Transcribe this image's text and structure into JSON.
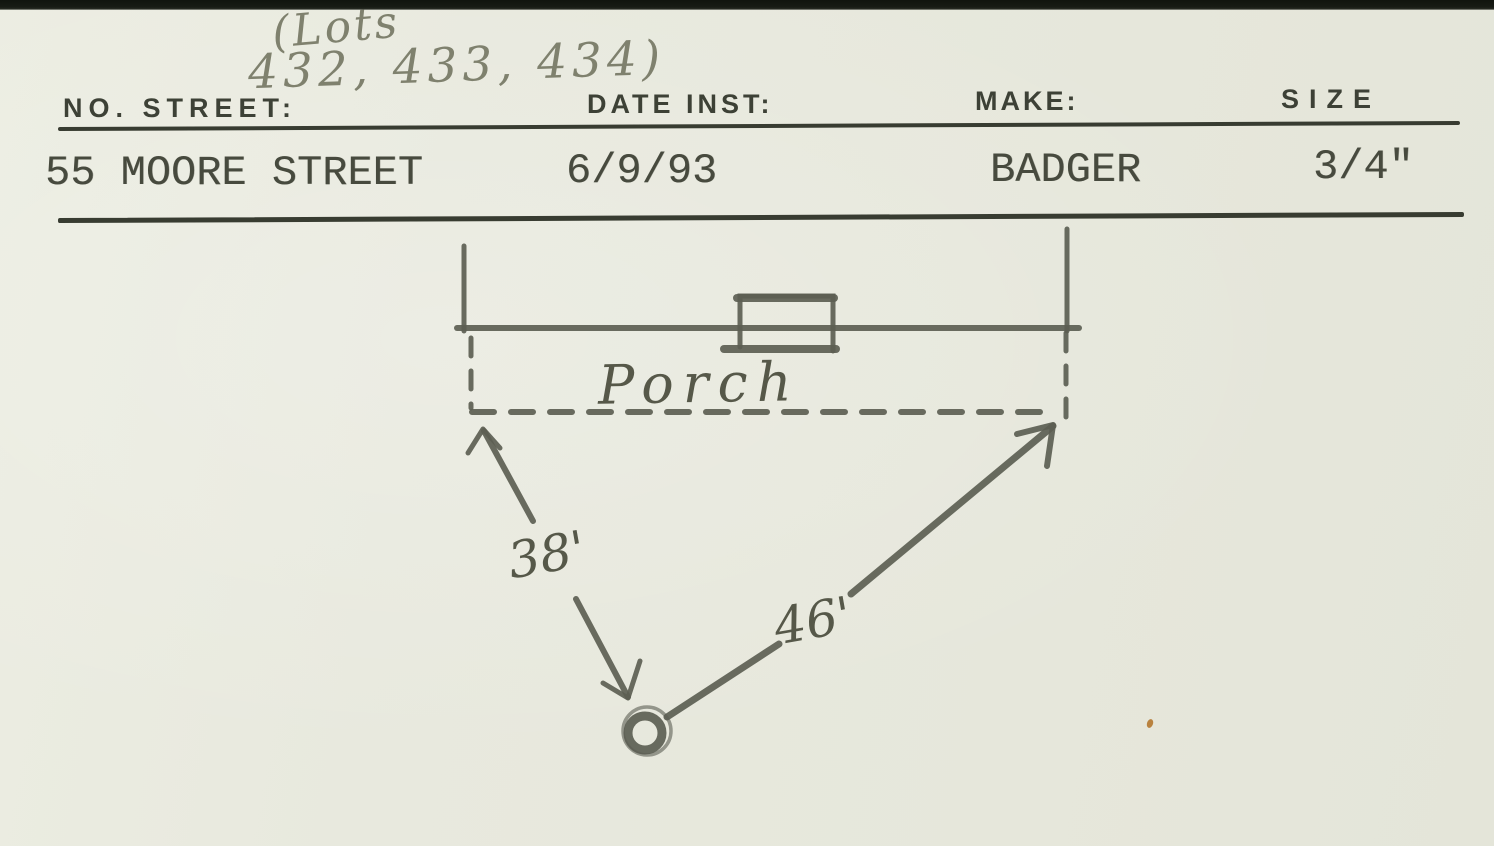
{
  "card": {
    "handwritten_note": {
      "line1": "(Lots",
      "line2": "432, 433, 434)"
    },
    "header": {
      "no_street_label": "NO. STREET:",
      "date_inst_label": "DATE INST:",
      "make_label": "MAKE:",
      "size_label": "SIZE"
    },
    "record": {
      "no_street": "55 MOORE STREET",
      "date_inst": "6/9/93",
      "make": "BADGER",
      "size": "3/4\""
    },
    "sketch": {
      "porch_label": "Porch",
      "left_distance": "38'",
      "right_distance": "46'"
    },
    "colors": {
      "paper": "#e8e9de",
      "printed_ink": "#3d4136",
      "typewriter_ink": "#474a3e",
      "pencil_dark": "#565849",
      "pencil_light": "#7f816e",
      "top_edge": "#171b14",
      "speck": "#b9823f"
    }
  }
}
